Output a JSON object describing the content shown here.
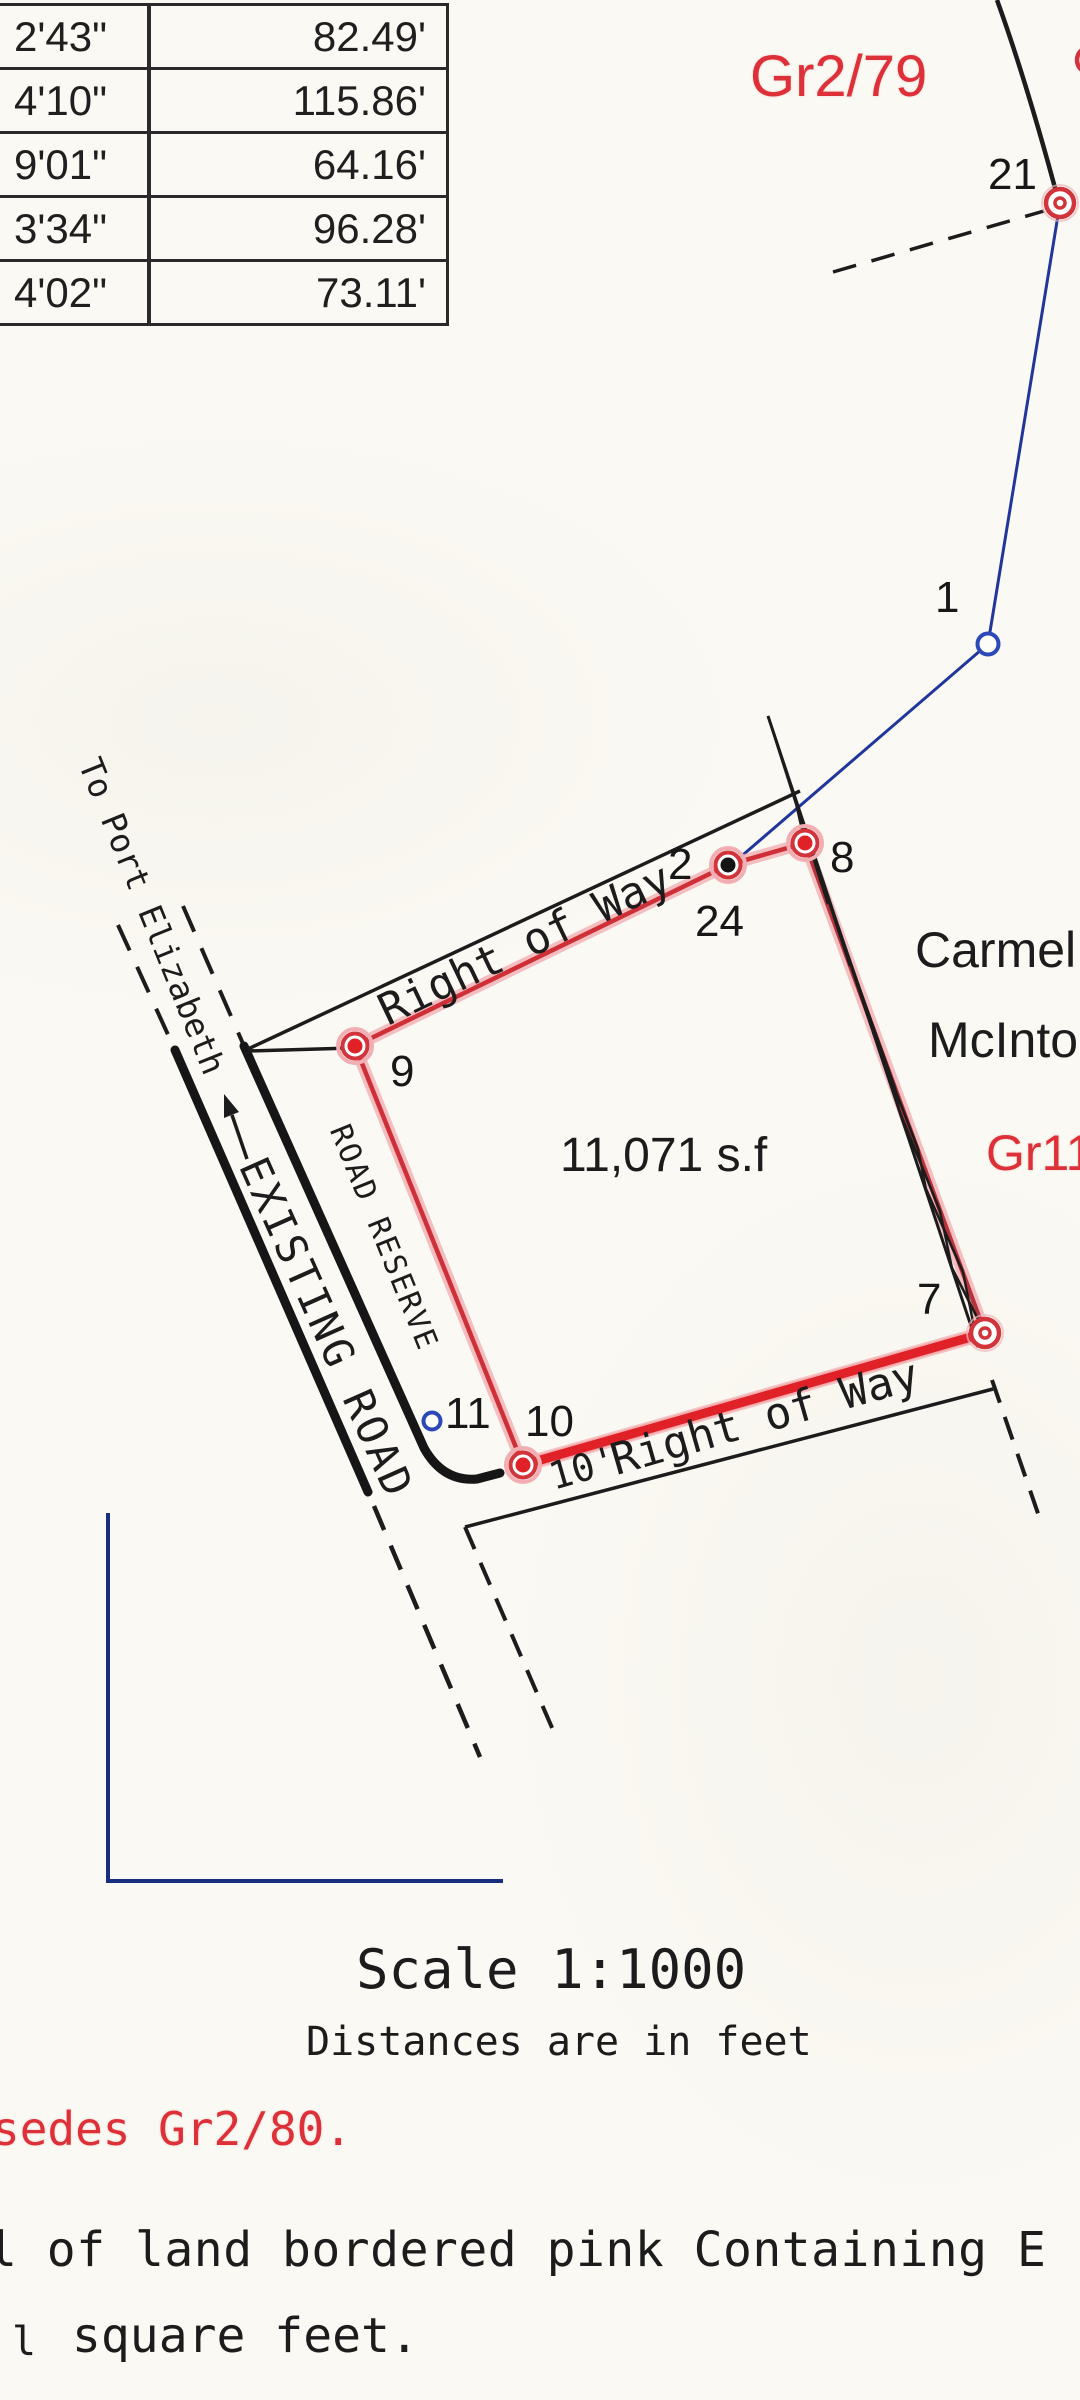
{
  "table": {
    "rows": [
      {
        "bearing": "2'43\"",
        "distance": "82.49'"
      },
      {
        "bearing": "4'10\"",
        "distance": "115.86'"
      },
      {
        "bearing": "9'01\"",
        "distance": "64.16'"
      },
      {
        "bearing": "3'34\"",
        "distance": "96.28'"
      },
      {
        "bearing": "4'02\"",
        "distance": "73.11'"
      }
    ]
  },
  "plan": {
    "parcel_area": "11,071 s.f",
    "labels": {
      "gr2_79": "Gr2/79",
      "gr11": "Gr11",
      "owner_line1": "Carmel",
      "owner_line2": "McInto",
      "right_of_way_top": "Right of Way",
      "right_of_way_bottom": "Right of Way",
      "row_width": "10'",
      "road_reserve": "ROAD RESERVE",
      "existing_road": "EXISTING ROAD",
      "to_port_elizabeth": "To Port Elizabeth"
    },
    "points": {
      "p21": "21",
      "p1": "1",
      "p2": "2",
      "p24": "24",
      "p8": "8",
      "p9": "9",
      "p10": "10",
      "p11": "11",
      "p7": "7"
    }
  },
  "footer": {
    "scale": "Scale 1:1000",
    "units_note": "Distances are in feet",
    "supersedes": "sedes Gr2/80.",
    "description_line1": "l of land bordered pink Containing E",
    "description_line2_prefix": "l",
    "description_line2": "square feet."
  },
  "colors": {
    "boundary_red": "#d2343c",
    "bright_red": "#e02127",
    "pink_glow": "#f2aeb3",
    "traverse_blue": "#20369b",
    "marker_blue": "#2b49b8",
    "frame_blue": "#162f80",
    "ink_black": "#1c1c1c",
    "red_text": "#dd3038",
    "paper": "#fbf9f3"
  }
}
